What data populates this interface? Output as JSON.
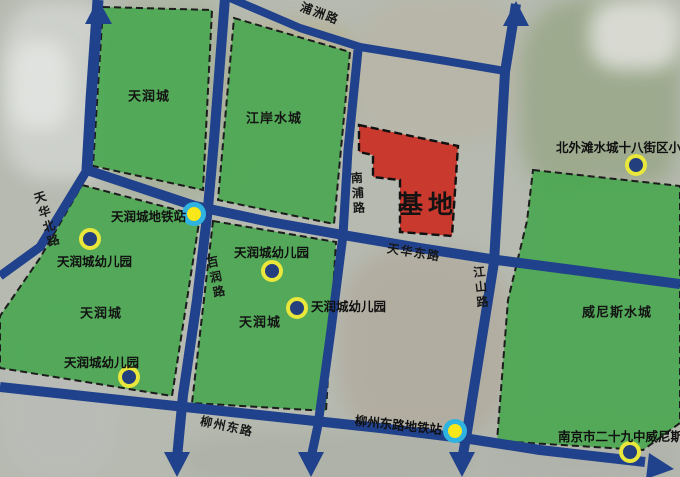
{
  "colors": {
    "residential_green": "#4BA852",
    "site_red": "#C9392E",
    "road_blue": "#20418C",
    "school_ring": "#E9E73C",
    "school_dot": "#243F7E",
    "metro_ring": "#2FB3E0",
    "metro_dot": "#F8E719"
  },
  "site": {
    "label": "基地"
  },
  "regions": [
    {
      "name": "tianrun-north",
      "label": "天润城",
      "x": 149,
      "y": 95
    },
    {
      "name": "jiangan-shuicheng",
      "label": "江岸水城",
      "x": 274,
      "y": 117
    },
    {
      "name": "tianrun-west",
      "label": "天润城",
      "x": 101,
      "y": 312
    },
    {
      "name": "tianrun-center",
      "label": "天润城",
      "x": 260,
      "y": 321
    },
    {
      "name": "venice-shuicheng",
      "label": "威尼斯水城",
      "x": 617,
      "y": 311
    }
  ],
  "roads": [
    {
      "name": "puzhou-road",
      "label": "浦洲路",
      "x": 320,
      "y": 13,
      "rotate": 20,
      "vertical": false
    },
    {
      "name": "tianhua-north-road",
      "label": "天华北路",
      "x": 47,
      "y": 220,
      "rotate": -17,
      "vertical": true
    },
    {
      "name": "nanpu-road",
      "label": "南浦路",
      "x": 358,
      "y": 194,
      "rotate": -4,
      "vertical": true
    },
    {
      "name": "bairun-road",
      "label": "百润路",
      "x": 216,
      "y": 278,
      "rotate": -12,
      "vertical": true
    },
    {
      "name": "tianhua-east-road",
      "label": "天华东路",
      "x": 414,
      "y": 252,
      "rotate": 9,
      "vertical": false
    },
    {
      "name": "jiangshan-road",
      "label": "江山路",
      "x": 481,
      "y": 288,
      "rotate": -6,
      "vertical": true
    },
    {
      "name": "liuzhou-east-road",
      "label": "柳州东路",
      "x": 227,
      "y": 426,
      "rotate": 12,
      "vertical": false
    }
  ],
  "markers": [
    {
      "name": "tianrun-metro-station",
      "type": "metro",
      "label": "天润城地铁站",
      "x": 194,
      "y": 214,
      "label_x": 111,
      "label_y": 206,
      "label_rotate": 0
    },
    {
      "name": "liuzhou-east-metro-station",
      "type": "metro",
      "label": "柳州东路地铁站",
      "x": 455,
      "y": 431,
      "label_x": 356,
      "label_y": 410,
      "label_rotate": 6
    },
    {
      "name": "tianrun-kindergarten-nw",
      "type": "school",
      "label": "天润城幼儿园",
      "x": 90,
      "y": 239,
      "label_x": 57,
      "label_y": 251,
      "label_rotate": 0
    },
    {
      "name": "tianrun-kindergarten-mid-n",
      "type": "school",
      "label": "天润城幼儿园",
      "x": 272,
      "y": 271,
      "label_x": 234,
      "label_y": 242,
      "label_rotate": 0
    },
    {
      "name": "tianrun-kindergarten-mid-s",
      "type": "school",
      "label": "天润城幼儿园",
      "x": 297,
      "y": 308,
      "label_x": 311,
      "label_y": 296,
      "label_rotate": 0
    },
    {
      "name": "tianrun-kindergarten-sw",
      "type": "school",
      "label": "天润城幼儿园",
      "x": 129,
      "y": 377,
      "label_x": 64,
      "label_y": 352,
      "label_rotate": 0
    },
    {
      "name": "beiwaitan-18th-block-school",
      "type": "school",
      "label": "北外滩水城十八街区小",
      "x": 636,
      "y": 165,
      "label_x": 556,
      "label_y": 137,
      "label_rotate": 0
    },
    {
      "name": "nanjing-no29-venice-school",
      "type": "school",
      "label": "南京市二十九中威尼斯水",
      "x": 630,
      "y": 452,
      "label_x": 558,
      "label_y": 426,
      "label_rotate": 0
    }
  ]
}
